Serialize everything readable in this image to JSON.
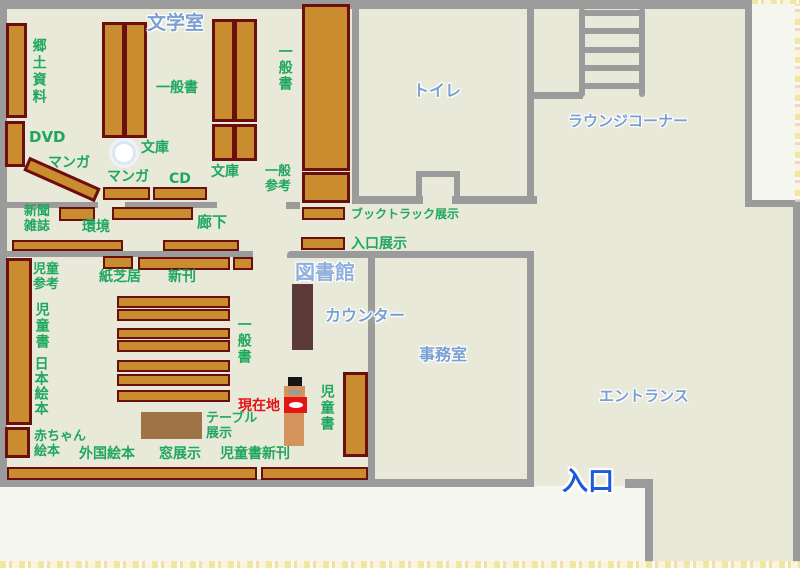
{
  "palette": {
    "floor": "#e9e9da",
    "wall": "#9b9b9b",
    "shelf_fill": "#c98c2e",
    "shelf_border": "#6b0e0e",
    "table_brown": "#9f7345",
    "counter_brown": "#5d3a3a",
    "label_green": "#1fa75f",
    "label_blue": "#7aa0d2",
    "library_blue": "#8fafdf",
    "entrance_blue": "#1b5ad8",
    "current_location_red": "#e01414",
    "paper": "#f6f6f1"
  },
  "rooms": {
    "literature_room": "文学室",
    "toilet": "トイレ",
    "lounge_corner": "ラウンジコーナー",
    "library": "図書館",
    "counter": "カウンター",
    "office": "事務室",
    "entrance_hall": "エントランス",
    "entrance_door": "入口"
  },
  "sections": {
    "local_materials": "郷土資料",
    "dvd": "DVD",
    "manga_diagonal": "マンガ",
    "manga_row": "マンガ",
    "bunko_pillar": "文庫",
    "bunko_pair": "文庫",
    "cd": "CD",
    "general_books_top": "一般書",
    "general_books_tall": "一般書",
    "general_books_children": "一般書",
    "general_reference": "一般\n参考",
    "booktruck_display": "ブックトラック展示",
    "entrance_display": "入口展示",
    "newspapers_magazines": "新聞\n雑誌",
    "environment": "環境",
    "corridor": "廊下",
    "kamishibai": "紙芝居",
    "new_arrivals": "新刊",
    "children_reference": "児童\n参考",
    "children_books_left": "児童書",
    "children_books_right": "児童書",
    "japanese_picture_books": "日本絵本",
    "baby_picture_books": "赤ちゃん\n絵本",
    "foreign_picture_books": "外国絵本",
    "window_display": "窓展示",
    "table_display": "テーブル\n展示",
    "children_new_arrivals": "児童書新刊"
  },
  "marker": {
    "current_location": "現在地"
  }
}
